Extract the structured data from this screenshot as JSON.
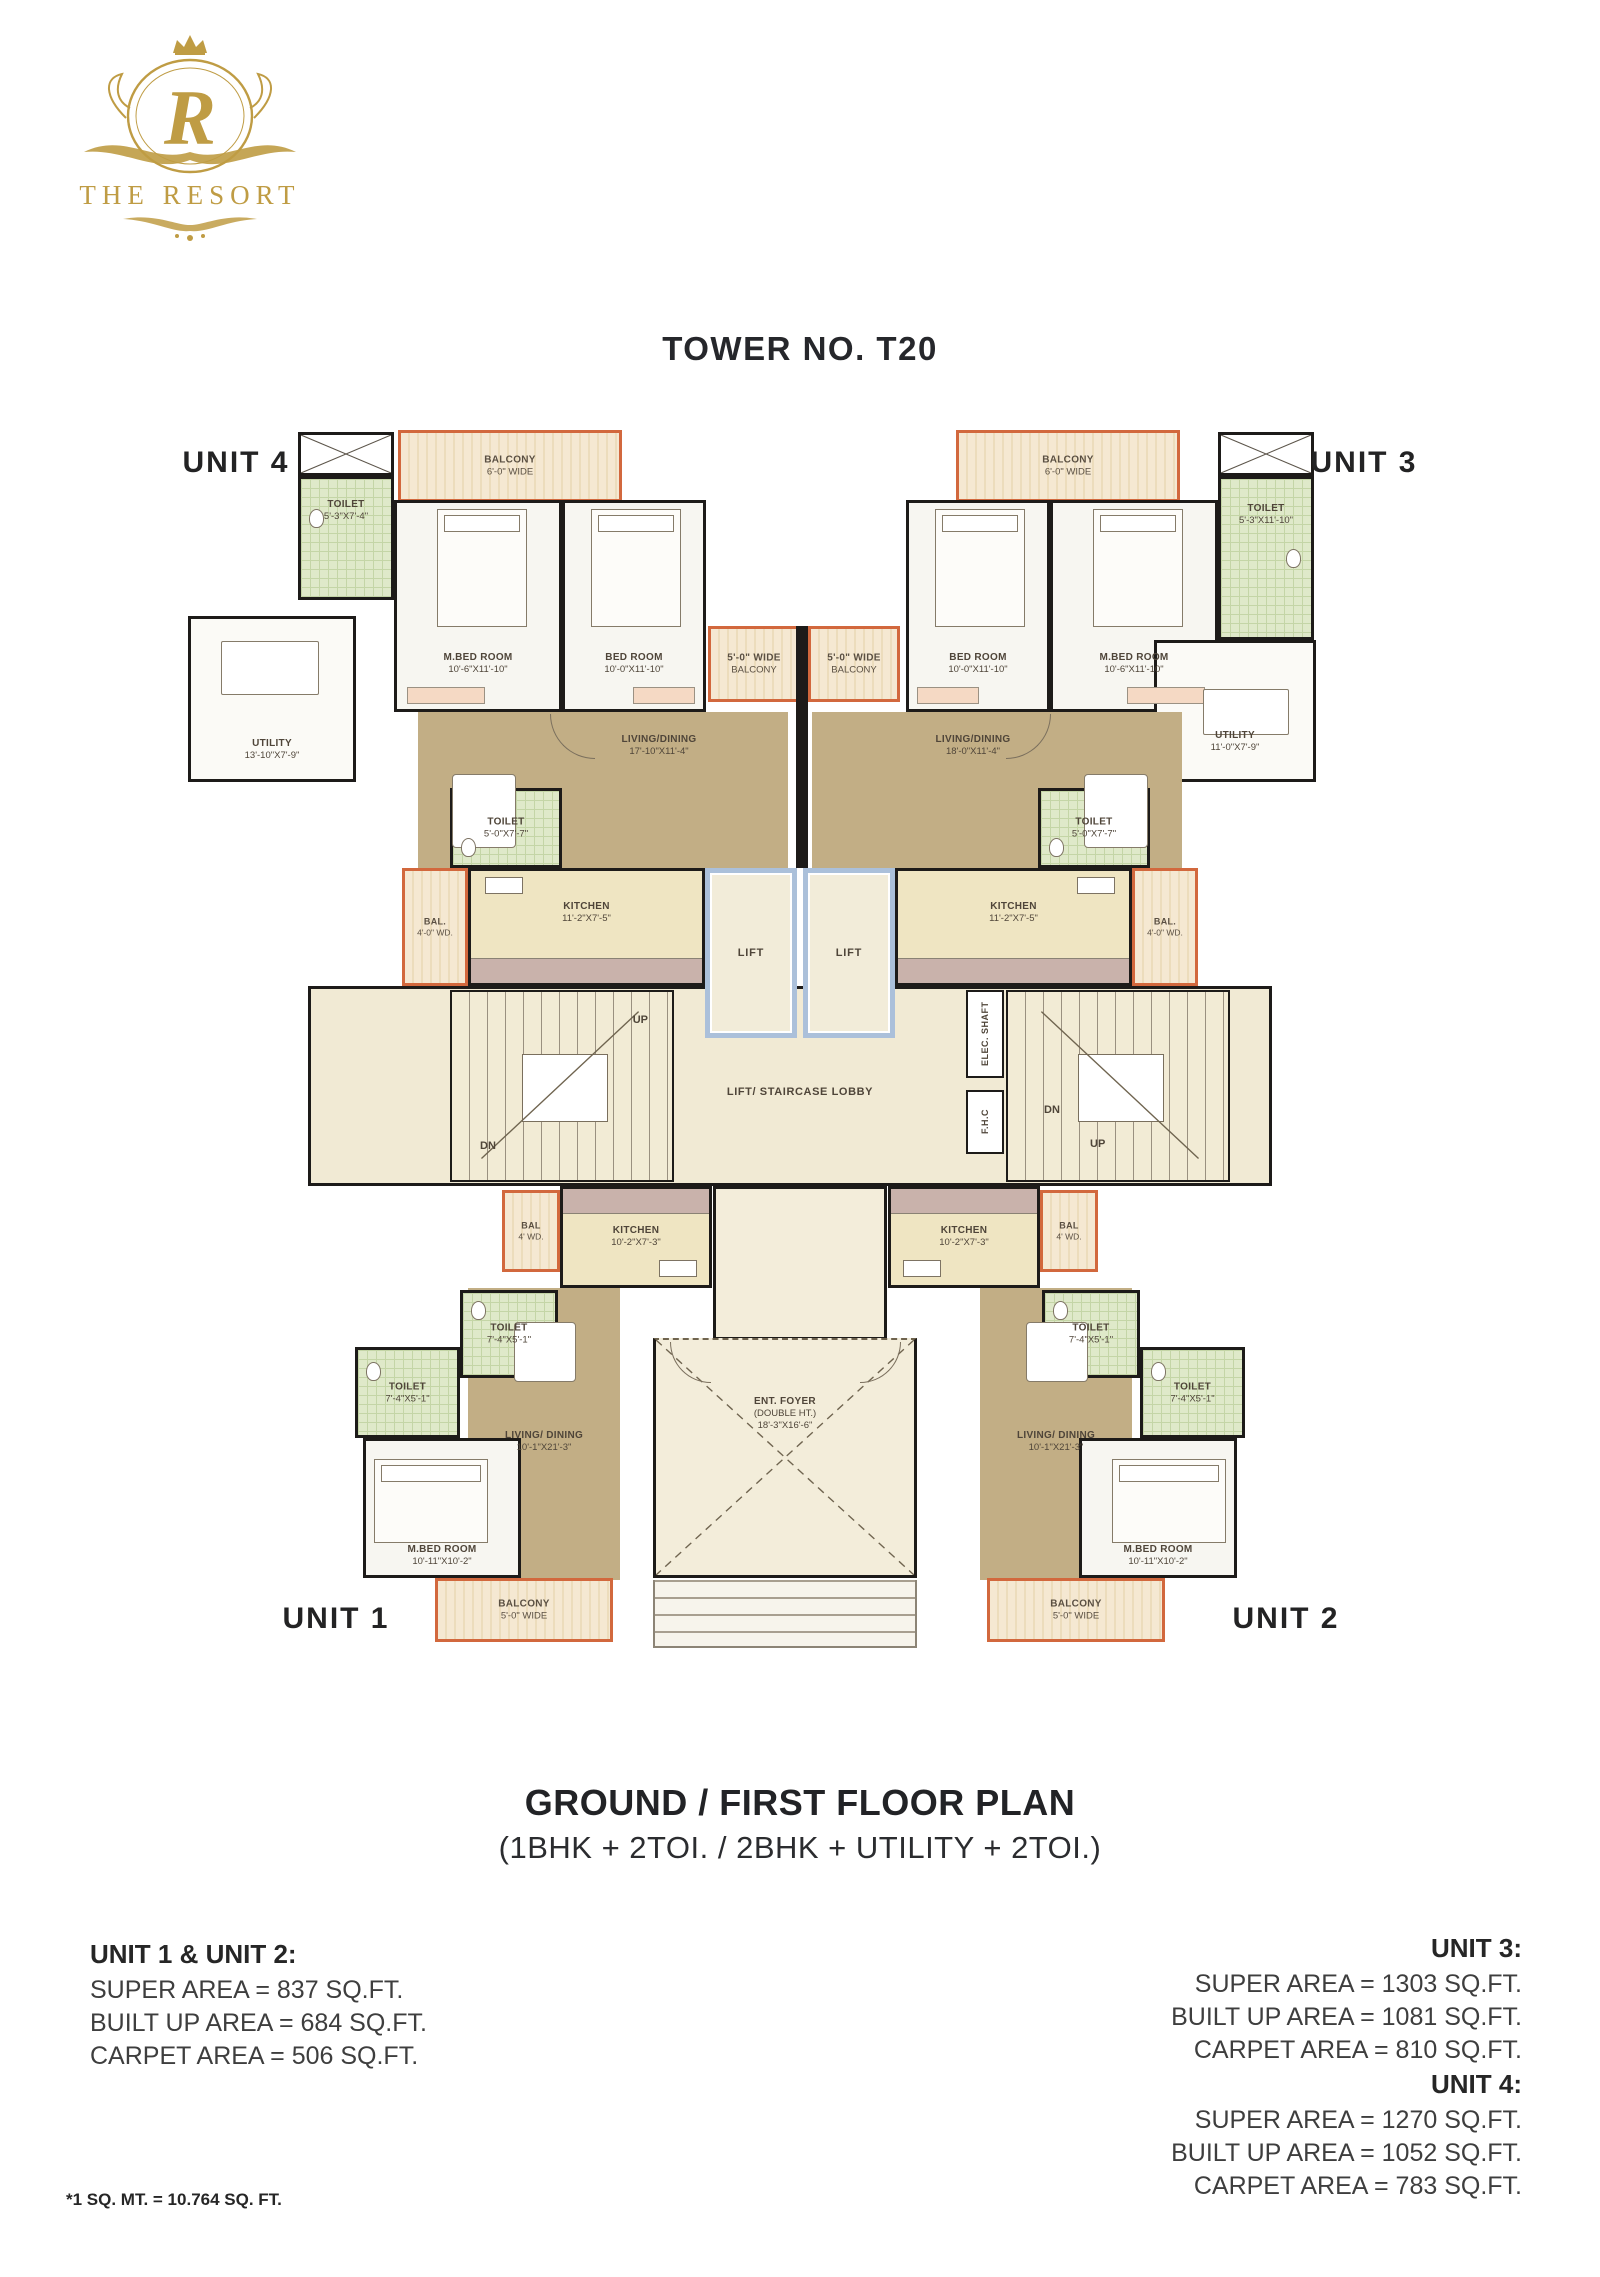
{
  "logo": {
    "monogram": "R",
    "brand": "THE RESORT",
    "crown_icon": "crown",
    "accent_gold": "#bf9c44"
  },
  "title": "TOWER NO. T20",
  "caption": {
    "heading": "GROUND / FIRST FLOOR PLAN",
    "subheading": "(1BHK + 2TOI. / 2BHK + UTILITY + 2TOI.)"
  },
  "plan": {
    "units": {
      "u1": "UNIT 1",
      "u2": "UNIT 2",
      "u3": "UNIT 3",
      "u4": "UNIT 4"
    },
    "stairs": {
      "up": "UP",
      "dn": "DN"
    },
    "rooms": {
      "balcony_top_left": {
        "name": "BALCONY",
        "dims": "6'-0\" WIDE"
      },
      "balcony_top_right": {
        "name": "BALCONY",
        "dims": "6'-0\" WIDE"
      },
      "toilet_u4_top": {
        "name": "TOILET",
        "dims": "5'-3\"X7'-4\""
      },
      "toilet_u3_top": {
        "name": "TOILET",
        "dims": "5'-3\"X11'-10\""
      },
      "mbed_u4": {
        "name": "M.BED ROOM",
        "dims": "10'-6\"X11'-10\""
      },
      "bed_u4": {
        "name": "BED ROOM",
        "dims": "10'-0\"X11'-10\""
      },
      "bed_u3": {
        "name": "BED ROOM",
        "dims": "10'-0\"X11'-10\""
      },
      "mbed_u3": {
        "name": "M.BED ROOM",
        "dims": "10'-6\"X11'-10\""
      },
      "utility_u4": {
        "name": "UTILITY",
        "dims": "13'-10\"X7'-9\""
      },
      "utility_u3": {
        "name": "UTILITY",
        "dims": "11'-0\"X7'-9\""
      },
      "balc5_left": {
        "name": "5'-0\" WIDE",
        "dims": "BALCONY"
      },
      "balc5_right": {
        "name": "5'-0\" WIDE",
        "dims": "BALCONY"
      },
      "living_u4": {
        "name": "LIVING/DINING",
        "dims": "17'-10\"X11'-4\""
      },
      "living_u3": {
        "name": "LIVING/DINING",
        "dims": "18'-0\"X11'-4\""
      },
      "toilet_u4_mid": {
        "name": "TOILET",
        "dims": "5'-0\"X7'-7\""
      },
      "toilet_u3_mid": {
        "name": "TOILET",
        "dims": "5'-0\"X7'-7\""
      },
      "kitchen_u4": {
        "name": "KITCHEN",
        "dims": "11'-2\"X7'-5\""
      },
      "kitchen_u3": {
        "name": "KITCHEN",
        "dims": "11'-2\"X7'-5\""
      },
      "bal_mid_left": {
        "name": "BAL.",
        "dims": "4'-0\" WD."
      },
      "bal_mid_right": {
        "name": "BAL.",
        "dims": "4'-0\" WD."
      },
      "lift1": {
        "name": "LIFT"
      },
      "lift2": {
        "name": "LIFT"
      },
      "lobby": {
        "name": "LIFT/ STAIRCASE LOBBY"
      },
      "elec_shaft": {
        "name": "ELEC. SHAFT"
      },
      "fhc": {
        "name": "F.H.C"
      },
      "kitchen_u1": {
        "name": "KITCHEN",
        "dims": "10'-2\"X7'-3\""
      },
      "kitchen_u2": {
        "name": "KITCHEN",
        "dims": "10'-2\"X7'-3\""
      },
      "bal_u1": {
        "name": "BAL",
        "dims": "4' WD."
      },
      "bal_u2": {
        "name": "BAL",
        "dims": "4' WD."
      },
      "toilet_u1_a": {
        "name": "TOILET",
        "dims": "7'-4\"X5'-1\""
      },
      "toilet_u1_b": {
        "name": "TOILET",
        "dims": "7'-4\"X5'-1\""
      },
      "toilet_u2_a": {
        "name": "TOILET",
        "dims": "7'-4\"X5'-1\""
      },
      "toilet_u2_b": {
        "name": "TOILET",
        "dims": "7'-4\"X5'-1\""
      },
      "living_u1": {
        "name": "LIVING/ DINING",
        "dims": "10'-1\"X21'-3\""
      },
      "living_u2": {
        "name": "LIVING/ DINING",
        "dims": "10'-1\"X21'-3\""
      },
      "mbed_u1": {
        "name": "M.BED ROOM",
        "dims": "10'-11\"X10'-2\""
      },
      "mbed_u2": {
        "name": "M.BED ROOM",
        "dims": "10'-11\"X10'-2\""
      },
      "foyer": {
        "name": "ENT. FOYER",
        "sub": "(DOUBLE HT.)",
        "dims": "18'-3\"X16'-6\""
      },
      "balcony_u1": {
        "name": "BALCONY",
        "dims": "5'-0\" WIDE"
      },
      "balcony_u2": {
        "name": "BALCONY",
        "dims": "5'-0\" WIDE"
      }
    }
  },
  "areas": [
    {
      "title": "UNIT 1 & UNIT 2:",
      "lines": [
        "SUPER AREA = 837 SQ.FT.",
        "BUILT UP AREA = 684 SQ.FT.",
        "CARPET AREA = 506 SQ.FT."
      ]
    },
    {
      "title": "UNIT 3:",
      "lines": [
        "SUPER AREA = 1303 SQ.FT.",
        "BUILT UP AREA = 1081 SQ.FT.",
        "CARPET AREA = 810 SQ.FT."
      ]
    },
    {
      "title": "UNIT 4:",
      "lines": [
        "SUPER AREA = 1270 SQ.FT.",
        "BUILT UP AREA = 1052 SQ.FT.",
        "CARPET AREA = 783 SQ.FT."
      ]
    }
  ],
  "footnote": "*1 SQ. MT. = 10.764 SQ. FT.",
  "colors": {
    "wall": "#1d1b19",
    "tan_floor": "#c2ae85",
    "lobby_cream": "#f1ead4",
    "toilet_green": "#dfe9c9",
    "balcony_orange": "#d2683d",
    "lift_blue": "#abc0da",
    "gold": "#bf9c44"
  }
}
